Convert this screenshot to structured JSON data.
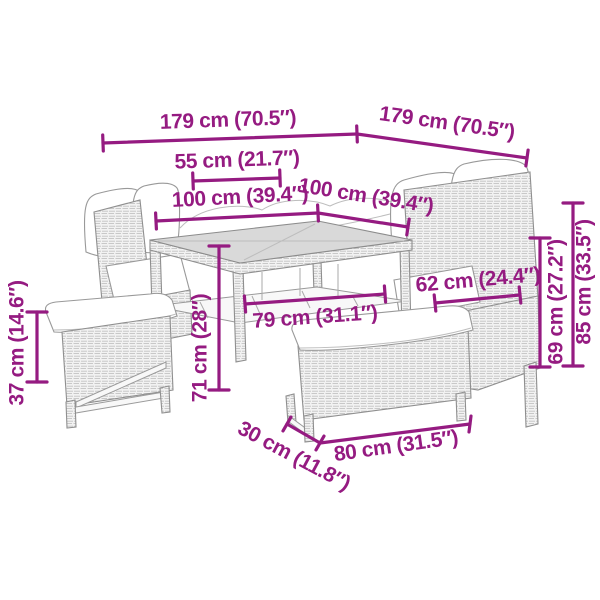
{
  "page": {
    "background": "#ffffff",
    "accent_color": "#951B81",
    "drawing_color": "#9a9a9a"
  },
  "diagram": {
    "kind": "product-dimension-line-drawing",
    "subject": "poly rattan garden lounge set with corner sofa, cube table and two benches",
    "dimensions": [
      {
        "name": "overall-width-left",
        "value_cm": 179,
        "value_in": 70.5,
        "label": "179 cm (70.5″)"
      },
      {
        "name": "overall-width-right",
        "value_cm": 179,
        "value_in": 70.5,
        "label": "179 cm (70.5″)"
      },
      {
        "name": "seat-depth",
        "value_cm": 55,
        "value_in": 21.7,
        "label": "55 cm (21.7″)"
      },
      {
        "name": "table-top-left-edge",
        "value_cm": 100,
        "value_in": 39.4,
        "label": "100 cm (39.4″)"
      },
      {
        "name": "table-top-right-edge",
        "value_cm": 100,
        "value_in": 39.4,
        "label": "100 cm (39.4″)"
      },
      {
        "name": "sofa-seat-width",
        "value_cm": 62,
        "value_in": 24.4,
        "label": "62 cm (24.4″)"
      },
      {
        "name": "table-length",
        "value_cm": 79,
        "value_in": 31.1,
        "label": "79 cm (31.1″)"
      },
      {
        "name": "table-height",
        "value_cm": 71,
        "value_in": 28,
        "label": "71 cm (28″)"
      },
      {
        "name": "bench-height",
        "value_cm": 37,
        "value_in": 14.6,
        "label": "37 cm (14.6″)"
      },
      {
        "name": "backrest-height",
        "value_cm": 69,
        "value_in": 27.2,
        "label": "69 cm (27.2″)"
      },
      {
        "name": "overall-height",
        "value_cm": 85,
        "value_in": 33.5,
        "label": "85 cm (33.5″)"
      },
      {
        "name": "bench-depth",
        "value_cm": 30,
        "value_in": 11.8,
        "label": "30 cm (11.8″)"
      },
      {
        "name": "bench-length",
        "value_cm": 80,
        "value_in": 31.5,
        "label": "80 cm (31.5″)"
      }
    ]
  }
}
